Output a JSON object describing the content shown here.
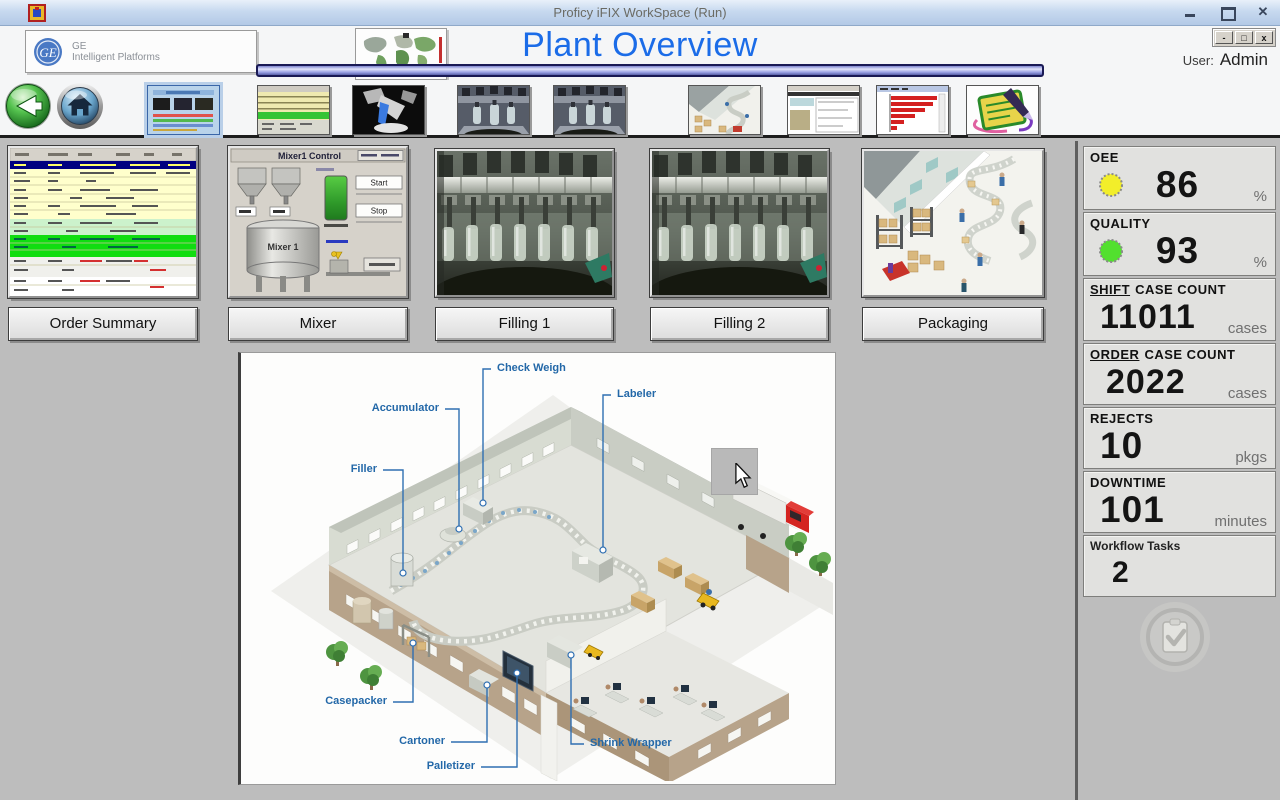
{
  "window": {
    "title": "Proficy iFIX WorkSpace (Run)"
  },
  "header": {
    "logo": {
      "line1": "GE",
      "line2": "Intelligent Platforms"
    },
    "page_title": "Plant Overview",
    "user_label": "User:",
    "user_name": "Admin"
  },
  "nav": {
    "icons": [
      "back-icon",
      "home-icon"
    ],
    "thumbnails": [
      "plant-overview",
      "order-summary",
      "mixer",
      "filling-1",
      "filling-2",
      "packaging",
      "reports",
      "downtime-pareto",
      "workflow-tasks"
    ]
  },
  "panels": {
    "order_summary": {
      "label": "Order Summary"
    },
    "mixer": {
      "label": "Mixer",
      "preview": {
        "title": "Mixer1 Control",
        "tank": "Mixer 1",
        "start": "Start",
        "stop": "Stop"
      }
    },
    "filling1": {
      "label": "Filling 1"
    },
    "filling2": {
      "label": "Filling 2"
    },
    "packaging": {
      "label": "Packaging"
    }
  },
  "diagram": {
    "labels": {
      "check_weigh": "Check Weigh",
      "labeler": "Labeler",
      "accumulator": "Accumulator",
      "filler": "Filler",
      "casepacker": "Casepacker",
      "cartoner": "Cartoner",
      "palletizer": "Palletizer",
      "shrink_wrapper": "Shrink Wrapper"
    }
  },
  "kpis": {
    "oee": {
      "label": "OEE",
      "value": "86",
      "unit": "%",
      "led_color": "#f2ee2a"
    },
    "quality": {
      "label": "QUALITY",
      "value": "93",
      "unit": "%",
      "led_color": "#52e02e"
    },
    "shift_case_count": {
      "label_prefix": "SHIFT",
      "label_rest": "CASE COUNT",
      "value": "11011",
      "unit": "cases"
    },
    "order_case_count": {
      "label_prefix": "ORDER",
      "label_rest": "CASE COUNT",
      "value": "2022",
      "unit": "cases"
    },
    "rejects": {
      "label": "REJECTS",
      "value": "10",
      "unit": "pkgs"
    },
    "downtime": {
      "label": "DOWNTIME",
      "value": "101",
      "unit": "minutes"
    },
    "workflow_tasks": {
      "label": "Workflow Tasks",
      "value": "2"
    }
  }
}
